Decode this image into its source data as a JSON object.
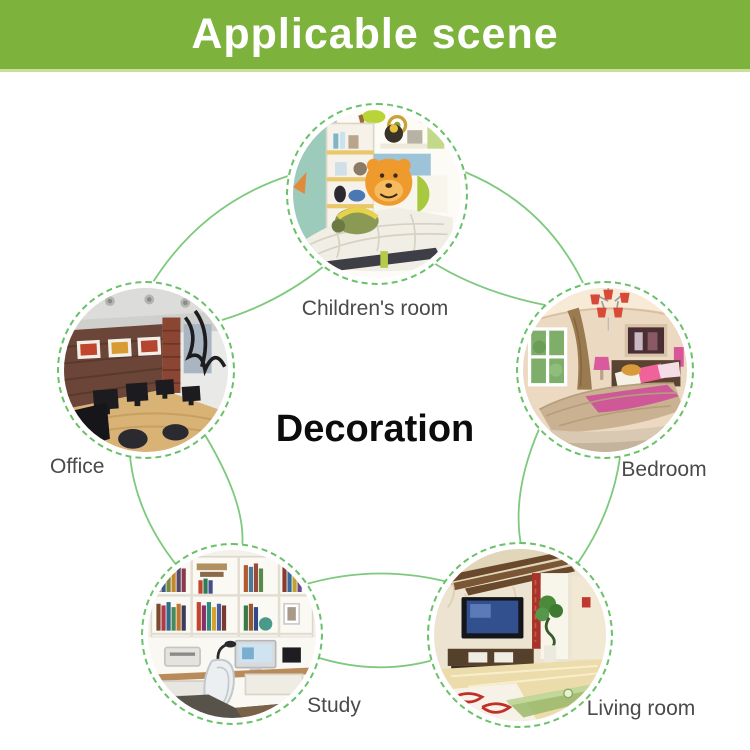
{
  "header": {
    "title": "Applicable scene",
    "bg_color": "#7db33c",
    "text_color": "#ffffff"
  },
  "center": {
    "title": "Decoration"
  },
  "scenes": [
    {
      "id": "childrens-room",
      "label": "Children's room",
      "position": "top"
    },
    {
      "id": "office",
      "label": "Office",
      "position": "left"
    },
    {
      "id": "bedroom",
      "label": "Bedroom",
      "position": "right"
    },
    {
      "id": "study",
      "label": "Study",
      "position": "bottom-left"
    },
    {
      "id": "living-room",
      "label": "Living room",
      "position": "bottom-right"
    }
  ],
  "colors": {
    "accent_green": "#69c169",
    "arc_green": "#7dc97d",
    "label_gray": "#4a4a4a",
    "header_underline": "#cadf9e"
  }
}
